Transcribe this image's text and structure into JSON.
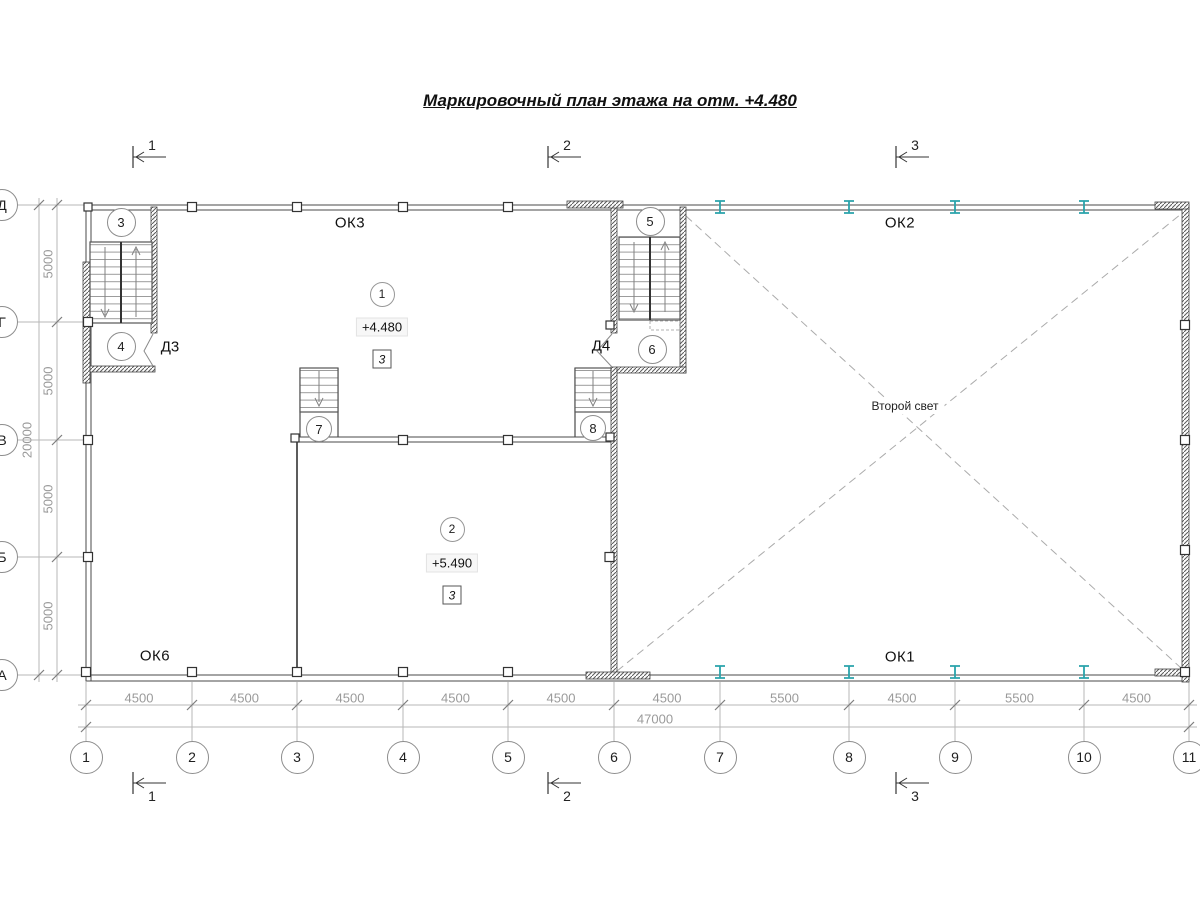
{
  "title": "Маркировочный план этажа на отм. +4.480",
  "colors": {
    "line": "#4a4a4a",
    "dim_gray": "#9a9a9a",
    "teal_column": "#2aa3ab"
  },
  "axes": {
    "rows": [
      "Д",
      "Г",
      "В",
      "Б",
      "А"
    ],
    "columns": [
      "1",
      "2",
      "3",
      "4",
      "5",
      "6",
      "7",
      "8",
      "9",
      "10",
      "11"
    ]
  },
  "sections": {
    "top": [
      "1",
      "2",
      "3"
    ],
    "bottom": [
      "1",
      "2",
      "3"
    ]
  },
  "dimensions": {
    "bottom_chain": [
      "4500",
      "4500",
      "4500",
      "4500",
      "4500",
      "4500",
      "5500",
      "4500",
      "5500",
      "4500"
    ],
    "bottom_total": "47000",
    "left_chain": [
      "5000",
      "5000",
      "5000",
      "5000"
    ],
    "left_total": "20000"
  },
  "rooms": [
    {
      "number": "1",
      "elevation": "+4.480",
      "floor_type": "3"
    },
    {
      "number": "2",
      "elevation": "+5.490",
      "floor_type": "3"
    }
  ],
  "stair_marks": [
    "3",
    "4",
    "5",
    "6",
    "7",
    "8"
  ],
  "window_marks": {
    "ok3": "ОК3",
    "ok2": "ОК2",
    "ok6": "ОК6",
    "ok1": "ОК1"
  },
  "door_marks": {
    "d3": "Д3",
    "d4": "Д4"
  },
  "annotations": {
    "second_light": "Второй свет"
  }
}
